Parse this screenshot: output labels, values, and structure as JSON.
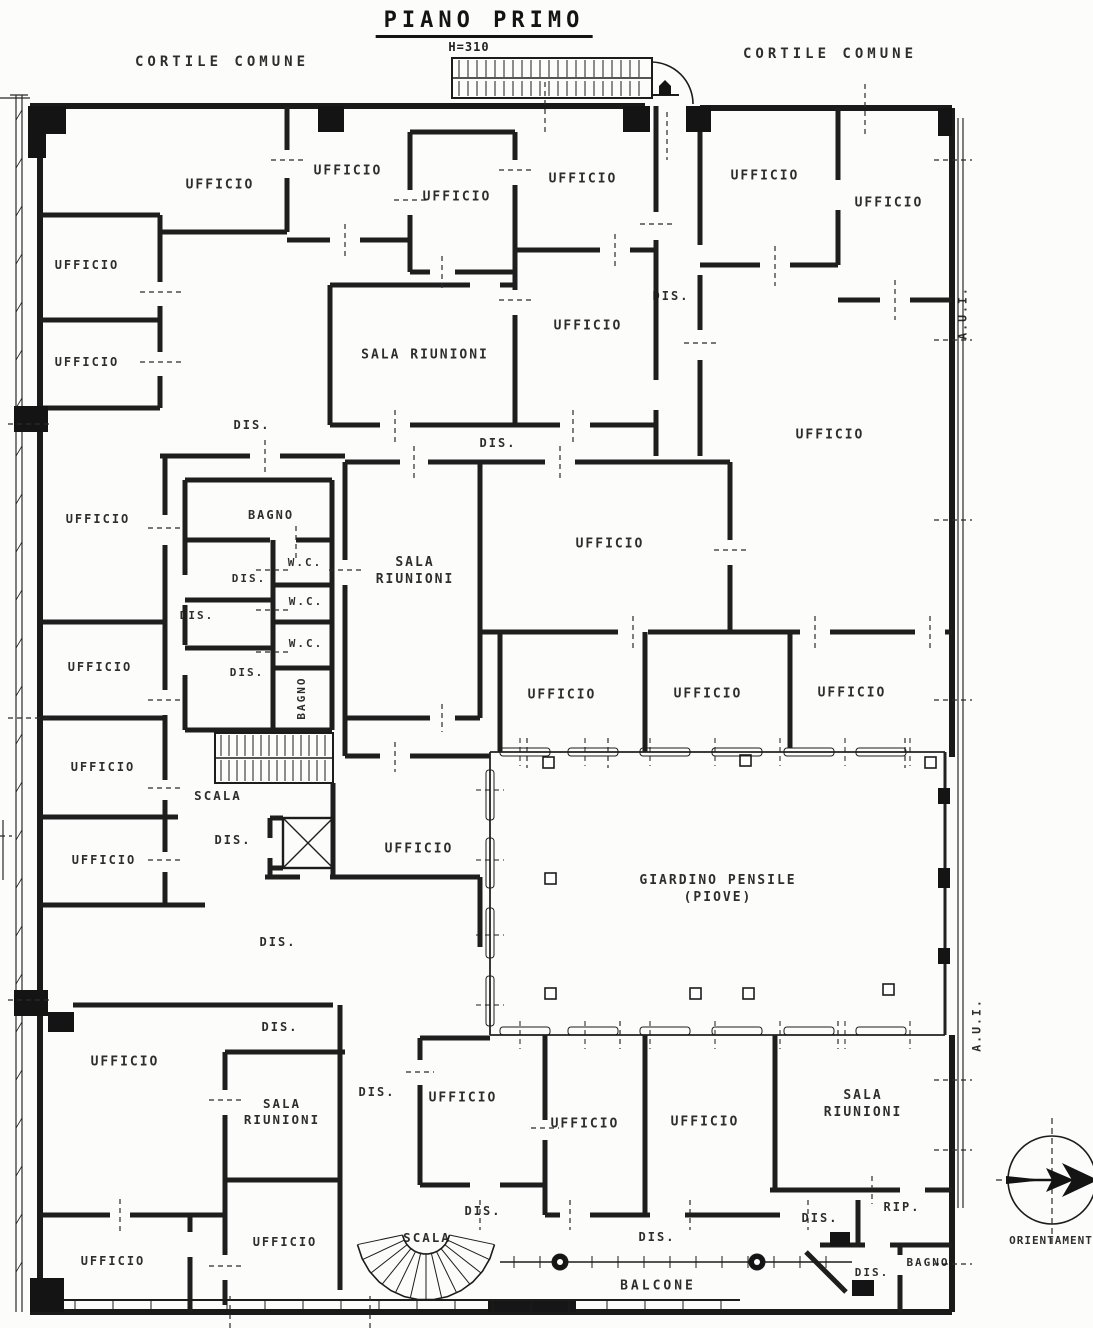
{
  "page": {
    "title": "PIANO PRIMO",
    "height_label": "H=310"
  },
  "plan": {
    "labels": [
      {
        "text": "CORTILE COMUNE",
        "name": "courtyard-label-left",
        "x": 222,
        "y": 62,
        "fs": 14,
        "ls": 4
      },
      {
        "text": "CORTILE COMUNE",
        "name": "courtyard-label-right",
        "x": 830,
        "y": 54,
        "fs": 14,
        "ls": 4
      },
      {
        "text": "UFFICIO",
        "name": "room-label-ufficio",
        "x": 220,
        "y": 186,
        "fs": 13
      },
      {
        "text": "UFFICIO",
        "name": "room-label-ufficio",
        "x": 348,
        "y": 172,
        "fs": 13
      },
      {
        "text": "UFFICIO",
        "name": "room-label-ufficio",
        "x": 457,
        "y": 198,
        "fs": 13
      },
      {
        "text": "UFFICIO",
        "name": "room-label-ufficio",
        "x": 583,
        "y": 180,
        "fs": 13
      },
      {
        "text": "UFFICIO",
        "name": "room-label-ufficio",
        "x": 765,
        "y": 177,
        "fs": 13
      },
      {
        "text": "UFFICIO",
        "name": "room-label-ufficio",
        "x": 889,
        "y": 204,
        "fs": 13
      },
      {
        "text": "UFFICIO",
        "name": "room-label-ufficio",
        "x": 87,
        "y": 266,
        "fs": 12
      },
      {
        "text": "UFFICIO",
        "name": "room-label-ufficio",
        "x": 87,
        "y": 363,
        "fs": 12
      },
      {
        "text": "DIS.",
        "name": "corridor-label-dis",
        "x": 671,
        "y": 297,
        "fs": 12
      },
      {
        "text": "UFFICIO",
        "name": "room-label-ufficio",
        "x": 588,
        "y": 327,
        "fs": 13
      },
      {
        "text": "SALA RIUNIONI",
        "name": "room-label-sala-riunioni",
        "x": 425,
        "y": 356,
        "fs": 13
      },
      {
        "text": "DIS.",
        "name": "corridor-label-dis",
        "x": 252,
        "y": 426,
        "fs": 12
      },
      {
        "text": "DIS.",
        "name": "corridor-label-dis",
        "x": 498,
        "y": 444,
        "fs": 12
      },
      {
        "text": "UFFICIO",
        "name": "room-label-ufficio",
        "x": 830,
        "y": 436,
        "fs": 13
      },
      {
        "text": "A.U.I.",
        "name": "shaft-label-aui",
        "x": 963,
        "y": 313,
        "fs": 11.5,
        "rot": -90
      },
      {
        "text": "BAGNO",
        "name": "room-label-bagno",
        "x": 271,
        "y": 516,
        "fs": 12
      },
      {
        "text": "UFFICIO",
        "name": "room-label-ufficio",
        "x": 98,
        "y": 520,
        "fs": 12
      },
      {
        "text": "SALA\nRIUNIONI",
        "name": "room-label-sala-riunioni",
        "x": 415,
        "y": 572,
        "fs": 13
      },
      {
        "text": "UFFICIO",
        "name": "room-label-ufficio",
        "x": 610,
        "y": 545,
        "fs": 13
      },
      {
        "text": "W.C.",
        "name": "room-label-wc",
        "x": 305,
        "y": 563,
        "fs": 11
      },
      {
        "text": "DIS.",
        "name": "corridor-label-dis",
        "x": 249,
        "y": 579,
        "fs": 11
      },
      {
        "text": "W.C.",
        "name": "room-label-wc",
        "x": 306,
        "y": 602,
        "fs": 11
      },
      {
        "text": "DIS.",
        "name": "corridor-label-dis",
        "x": 197,
        "y": 616,
        "fs": 11
      },
      {
        "text": "W.C.",
        "name": "room-label-wc",
        "x": 306,
        "y": 644,
        "fs": 11
      },
      {
        "text": "DIS.",
        "name": "corridor-label-dis",
        "x": 247,
        "y": 673,
        "fs": 11
      },
      {
        "text": "BAGNO",
        "name": "room-label-bagno",
        "x": 302,
        "y": 698,
        "fs": 11,
        "rot": -90
      },
      {
        "text": "UFFICIO",
        "name": "room-label-ufficio",
        "x": 100,
        "y": 668,
        "fs": 12
      },
      {
        "text": "UFFICIO",
        "name": "room-label-ufficio",
        "x": 562,
        "y": 696,
        "fs": 13
      },
      {
        "text": "UFFICIO",
        "name": "room-label-ufficio",
        "x": 708,
        "y": 695,
        "fs": 13
      },
      {
        "text": "UFFICIO",
        "name": "room-label-ufficio",
        "x": 852,
        "y": 694,
        "fs": 13
      },
      {
        "text": "UFFICIO",
        "name": "room-label-ufficio",
        "x": 103,
        "y": 768,
        "fs": 12
      },
      {
        "text": "SCALA",
        "name": "stairs-label-scala",
        "x": 218,
        "y": 796,
        "fs": 12.5
      },
      {
        "text": "DIS.",
        "name": "corridor-label-dis",
        "x": 233,
        "y": 841,
        "fs": 12
      },
      {
        "text": "UFFICIO",
        "name": "room-label-ufficio",
        "x": 419,
        "y": 850,
        "fs": 13
      },
      {
        "text": "UFFICIO",
        "name": "room-label-ufficio",
        "x": 104,
        "y": 861,
        "fs": 12
      },
      {
        "text": "GIARDINO PENSILE\n(PIOVE)",
        "name": "garden-label",
        "x": 718,
        "y": 890,
        "fs": 13
      },
      {
        "text": "DIS.",
        "name": "corridor-label-dis",
        "x": 278,
        "y": 943,
        "fs": 12
      },
      {
        "text": "A.U.I.",
        "name": "shaft-label-aui",
        "x": 977,
        "y": 1025,
        "fs": 11.5,
        "rot": -90
      },
      {
        "text": "DIS.",
        "name": "corridor-label-dis",
        "x": 280,
        "y": 1028,
        "fs": 12
      },
      {
        "text": "UFFICIO",
        "name": "room-label-ufficio",
        "x": 125,
        "y": 1063,
        "fs": 13
      },
      {
        "text": "SALA\nRIUNIONI",
        "name": "room-label-sala-riunioni",
        "x": 282,
        "y": 1112,
        "fs": 12.5
      },
      {
        "text": "DIS.",
        "name": "corridor-label-dis",
        "x": 377,
        "y": 1093,
        "fs": 12
      },
      {
        "text": "UFFICIO",
        "name": "room-label-ufficio",
        "x": 463,
        "y": 1099,
        "fs": 13
      },
      {
        "text": "UFFICIO",
        "name": "room-label-ufficio",
        "x": 585,
        "y": 1125,
        "fs": 13
      },
      {
        "text": "UFFICIO",
        "name": "room-label-ufficio",
        "x": 705,
        "y": 1123,
        "fs": 13
      },
      {
        "text": "SALA\nRIUNIONI",
        "name": "room-label-sala-riunioni",
        "x": 863,
        "y": 1105,
        "fs": 13
      },
      {
        "text": "RIP.",
        "name": "room-label-rip",
        "x": 902,
        "y": 1208,
        "fs": 12
      },
      {
        "text": "DIS.",
        "name": "corridor-label-dis",
        "x": 820,
        "y": 1219,
        "fs": 12
      },
      {
        "text": "DIS.",
        "name": "corridor-label-dis",
        "x": 483,
        "y": 1212,
        "fs": 12
      },
      {
        "text": "UFFICIO",
        "name": "room-label-ufficio",
        "x": 285,
        "y": 1243,
        "fs": 12
      },
      {
        "text": "SCALA",
        "name": "stairs-label-scala",
        "x": 427,
        "y": 1238,
        "fs": 12.5
      },
      {
        "text": "DIS.",
        "name": "corridor-label-dis",
        "x": 657,
        "y": 1238,
        "fs": 12
      },
      {
        "text": "UFFICIO",
        "name": "room-label-ufficio",
        "x": 113,
        "y": 1262,
        "fs": 12
      },
      {
        "text": "DIS.",
        "name": "corridor-label-dis",
        "x": 872,
        "y": 1273,
        "fs": 11
      },
      {
        "text": "BAGNO",
        "name": "room-label-bagno",
        "x": 928,
        "y": 1263,
        "fs": 11
      },
      {
        "text": "BALCONE",
        "name": "balcony-label",
        "x": 658,
        "y": 1287,
        "fs": 13,
        "ls": 3
      },
      {
        "text": "ORIENTAMENT",
        "name": "compass-label",
        "x": 1051,
        "y": 1241,
        "fs": 11,
        "ls": 1
      }
    ]
  }
}
